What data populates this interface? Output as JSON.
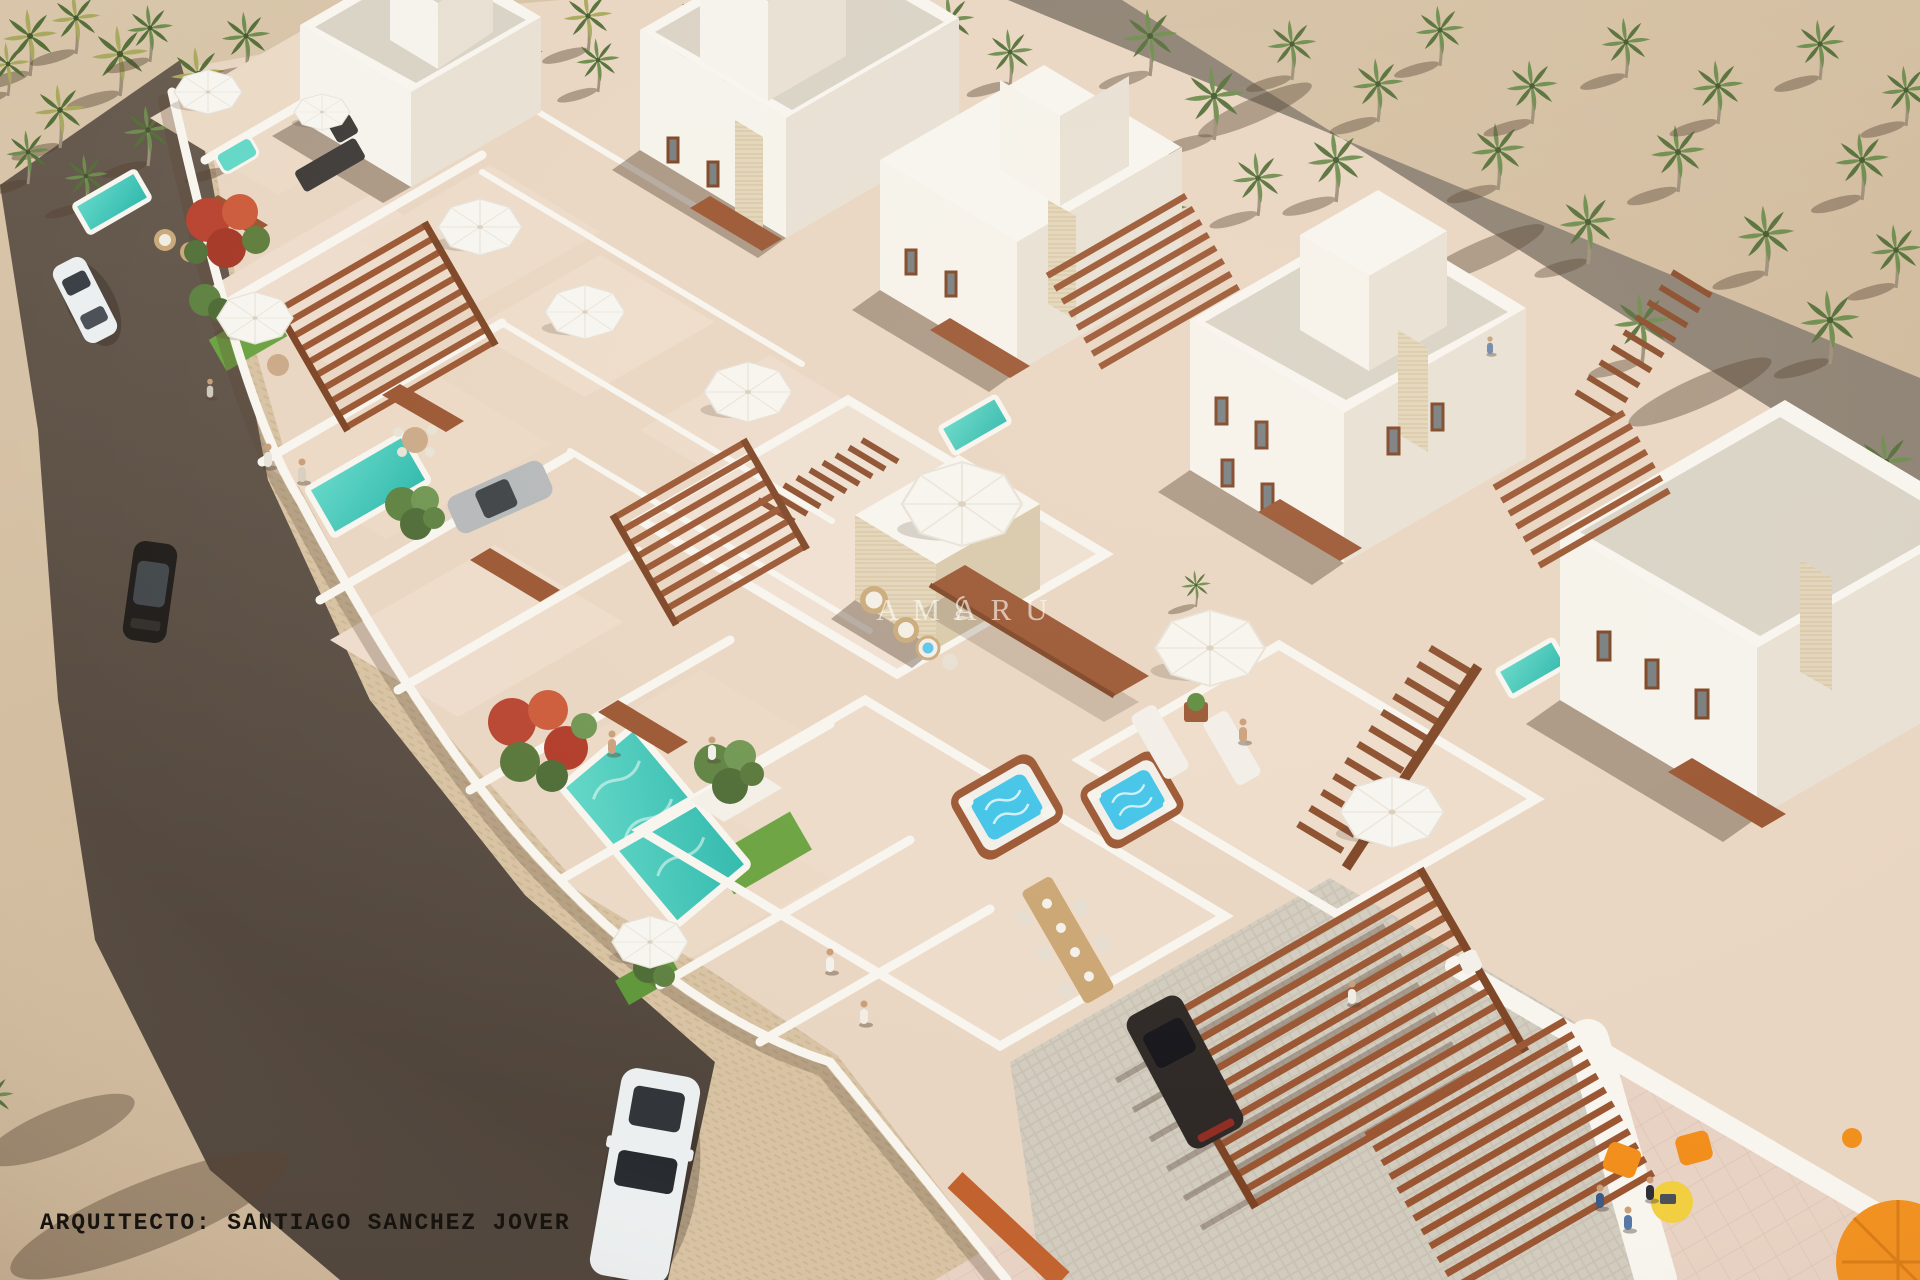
{
  "title": "Aerial 3D render — whitewashed villa development with palm grove",
  "watermark": {
    "brand": "AMARU",
    "logo": "swan-flourish-icon"
  },
  "credit": {
    "label": "ARQUITECTO: SANTIAGO SANCHEZ JOVER"
  },
  "palette": {
    "sand": "#d3bd9e",
    "sand_light": "#dcc9ae",
    "road_top": "#675a4e",
    "road_bottom": "#4c4138",
    "side": "#d7c2a3",
    "side_dash": "#cdb691",
    "floor": "#e9d6c2",
    "tile": "#e8d2c3",
    "tile_line": "#dcc4b5",
    "wall": "#f8f5ef",
    "face_bright": "#f6f3ec",
    "face_shade": "#e8e0d4",
    "gravel": "#d9d3c6",
    "stone": "#e3d5ba",
    "stone_line": "#d2c09c",
    "lane": "#8d8173",
    "cob": "#c9c2b4",
    "cob_light": "#d2ccbf",
    "pool": "#2cb8ac",
    "pool_light": "#62d8c8",
    "jacuzzi_water": "#3fc3e8",
    "wood": "#9a5531",
    "wood_dark": "#7c4323",
    "terracotta": "#c2622e",
    "lawn": "#6aa23f",
    "palm1": "#6d8c4d",
    "palm2": "#556f39",
    "palm3": "#a8a95e",
    "trunk": "#9d8e79",
    "shadow": "rgba(84,64,48,0.42)",
    "red_tree": "#b8432f",
    "car_white": "#eceff0",
    "car_black": "#211d1a",
    "car_silver": "#b5b8ba",
    "car_dark": "#2c2724",
    "accent_orange": "#f28f1c",
    "accent_yellow": "#f1cf3e",
    "skin": "#c99e78"
  },
  "scene": {
    "elements": [
      {
        "id": "palm-grove",
        "label": "Palm grove on sand",
        "count": 48
      },
      {
        "id": "access-road",
        "label": "Asphalt access road"
      },
      {
        "id": "pedestrian-sidewalk",
        "label": "Paved sidewalk"
      },
      {
        "id": "rear-lane",
        "label": "Rear service lane"
      },
      {
        "id": "villa-compound",
        "label": "Whitewashed villa compound"
      },
      {
        "id": "back-row-villas",
        "label": "Two-storey villas with roof terraces",
        "count": 5
      },
      {
        "id": "front-row-terraces",
        "label": "Garden terraces with pools",
        "count": 8
      },
      {
        "id": "swimming-pools",
        "label": "Turquoise pools",
        "count": 5
      },
      {
        "id": "jacuzzis",
        "label": "Square jacuzzis",
        "count": 3
      },
      {
        "id": "pergolas",
        "label": "Timber slat pergolas",
        "count": 6
      },
      {
        "id": "staircases",
        "label": "Timber staircases",
        "count": 3
      },
      {
        "id": "parasols",
        "label": "White parasols",
        "count": 10
      },
      {
        "id": "orange-lounge-set",
        "label": "Orange chairs, yellow table and parasol"
      },
      {
        "id": "vehicles",
        "label": "Cars",
        "items": [
          "white-hatchback-on-road",
          "black-suv-on-road",
          "silver-car-parked",
          "white-suv-foreground",
          "dark-suv-carport"
        ]
      },
      {
        "id": "residents",
        "label": "Tiny human figures",
        "count": 13
      },
      {
        "id": "trees",
        "label": "Red flowering and green trees",
        "count": 6
      }
    ]
  }
}
